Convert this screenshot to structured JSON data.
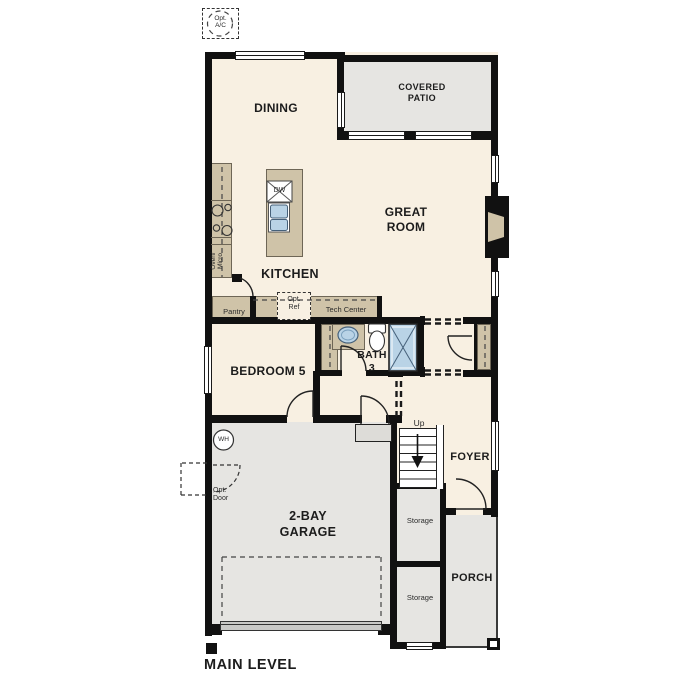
{
  "title": "MAIN LEVEL",
  "colors": {
    "wall": "#111111",
    "interior_floor": "#f8f0e2",
    "outdoor_concrete": "#e6e5e2",
    "counter_tan": "#cfc3a8",
    "fixture_blue": "#b9d3e6",
    "label_text": "#1c1c1c"
  },
  "rooms": {
    "dining": "DINING",
    "covered_patio": "COVERED\nPATIO",
    "great_room": "GREAT\nROOM",
    "kitchen": "KITCHEN",
    "bedroom5": "BEDROOM 5",
    "bath3": "BATH\n3",
    "garage": "2-BAY\nGARAGE",
    "foyer": "FOYER",
    "porch": "PORCH",
    "storage_under_stairs": "Storage",
    "storage_rear": "Storage"
  },
  "annotations": {
    "opt_ac": "Opt.\nA/C",
    "opt_ref": "Opt.\nRef",
    "opt_door": "Opt.\nDoor",
    "pantry": "Pantry",
    "tech_center": "Tech Center",
    "oven_micro": "Oven/\nMicro",
    "dishwasher": "DW",
    "water_heater": "WH",
    "stairs_up": "Up"
  }
}
